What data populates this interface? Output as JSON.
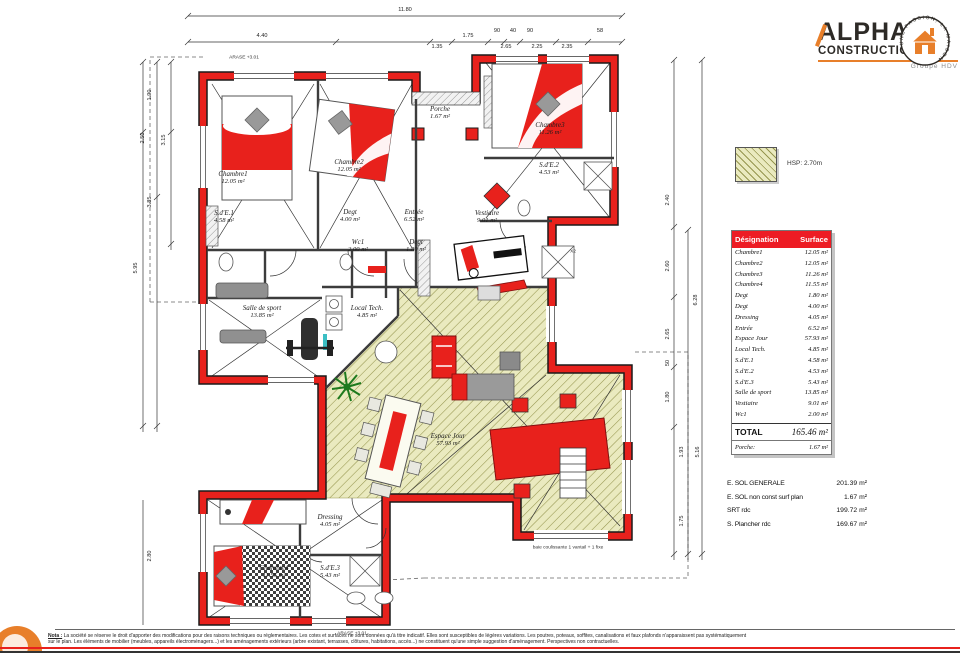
{
  "logo": {
    "name": "ALPHA",
    "name2": "CONSTRUCTIONS",
    "subtitle": "Groupe HDV",
    "stamp_text": "UNE PASSION, LA MAISON",
    "accent_color": "#e87f2a",
    "dark_color": "#2d2a26"
  },
  "legend": {
    "label": "HSP: 2.70m"
  },
  "surface_table": {
    "header": {
      "designation": "Désignation",
      "surface": "Surface"
    },
    "rows": [
      {
        "name": "Chambre1",
        "area": "12.05 m²"
      },
      {
        "name": "Chambre2",
        "area": "12.05 m²"
      },
      {
        "name": "Chambre3",
        "area": "11.26 m²"
      },
      {
        "name": "Chambre4",
        "area": "11.55 m²"
      },
      {
        "name": "Degt",
        "area": "1.80 m²"
      },
      {
        "name": "Degt",
        "area": "4.00 m²"
      },
      {
        "name": "Dressing",
        "area": "4.05 m²"
      },
      {
        "name": "Entrée",
        "area": "6.52 m²"
      },
      {
        "name": "Espace Jour",
        "area": "57.93 m²"
      },
      {
        "name": "Local Tech.",
        "area": "4.85 m²"
      },
      {
        "name": "S.d'E.1",
        "area": "4.58 m²"
      },
      {
        "name": "S.d'E.2",
        "area": "4.53 m²"
      },
      {
        "name": "S.d'E.3",
        "area": "5.43 m²"
      },
      {
        "name": "Salle de sport",
        "area": "13.85 m²"
      },
      {
        "name": "Vestiaire",
        "area": "9.01 m²"
      },
      {
        "name": "Wc1",
        "area": "2.00 m²"
      }
    ],
    "total_label": "TOTAL",
    "total_value": "165.46 m²",
    "porche_label": "Porche:",
    "porche_value": "1.67 m²"
  },
  "totals": {
    "rows": [
      {
        "label": "E. SOL GENERALE",
        "value": "201.39 m²"
      },
      {
        "label": "E. SOL non const surf plan",
        "value": "1.67 m²"
      },
      {
        "label": "SRT rdc",
        "value": "199.72 m²"
      },
      {
        "label": "S. Plancher rdc",
        "value": "169.67 m²"
      }
    ]
  },
  "plan": {
    "colors": {
      "wall": "#e8211c",
      "hatch_fill": "#eaeabf",
      "hatch_line": "#96964f"
    },
    "rooms": [
      {
        "name": "Chambre1",
        "area": "12.05 m²",
        "x": 233,
        "y": 178
      },
      {
        "name": "Chambre2",
        "area": "12.05 m²",
        "x": 349,
        "y": 166
      },
      {
        "name": "Chambre3",
        "area": "11.26 m²",
        "x": 550,
        "y": 129
      },
      {
        "name": "Chambre4",
        "area": "11.55 m²",
        "x": 274,
        "y": 572
      },
      {
        "name": "S.d'E.1",
        "area": "4.58 m²",
        "x": 224,
        "y": 217
      },
      {
        "name": "S.d'E.2",
        "area": "4.53 m²",
        "x": 549,
        "y": 169
      },
      {
        "name": "S.d'E.3",
        "area": "5.43 m²",
        "x": 330,
        "y": 572
      },
      {
        "name": "Degt",
        "area": "4.00 m²",
        "x": 350,
        "y": 216
      },
      {
        "name": "Degt",
        "area": "1.80 m²",
        "x": 416,
        "y": 246
      },
      {
        "name": "Dressing",
        "area": "4.05 m²",
        "x": 330,
        "y": 521
      },
      {
        "name": "Entrée",
        "area": "6.52 m²",
        "x": 414,
        "y": 216
      },
      {
        "name": "Wc1",
        "area": "2.00 m²",
        "x": 358,
        "y": 246
      },
      {
        "name": "Local Tech.",
        "area": "4.85 m²",
        "x": 367,
        "y": 312
      },
      {
        "name": "Salle de sport",
        "area": "13.85 m²",
        "x": 262,
        "y": 312
      },
      {
        "name": "Vestiaire",
        "area": "9.01 m²",
        "x": 487,
        "y": 217
      },
      {
        "name": "Espace Jour",
        "area": "57.93 m²",
        "x": 448,
        "y": 440
      },
      {
        "name": "Porche",
        "area": "1.67 m²",
        "x": 440,
        "y": 113
      }
    ],
    "dims": [
      {
        "t": "11.80",
        "x": 405,
        "y": 10,
        "o": "h"
      },
      {
        "t": "4.40",
        "x": 262,
        "y": 36,
        "o": "h"
      },
      {
        "t": "1.35",
        "x": 437,
        "y": 47,
        "o": "h"
      },
      {
        "t": "1.75",
        "x": 468,
        "y": 36,
        "o": "h"
      },
      {
        "t": "90",
        "x": 497,
        "y": 31,
        "o": "h"
      },
      {
        "t": "40",
        "x": 513,
        "y": 31,
        "o": "h"
      },
      {
        "t": "90",
        "x": 530,
        "y": 31,
        "o": "h"
      },
      {
        "t": "2.65",
        "x": 506,
        "y": 47,
        "o": "h"
      },
      {
        "t": "2.25",
        "x": 537,
        "y": 47,
        "o": "h"
      },
      {
        "t": "2.35",
        "x": 567,
        "y": 47,
        "o": "h"
      },
      {
        "t": "58",
        "x": 600,
        "y": 31,
        "o": "h"
      },
      {
        "t": "1.90",
        "x": 150,
        "y": 95,
        "o": "v"
      },
      {
        "t": "2.50",
        "x": 143,
        "y": 138,
        "o": "v"
      },
      {
        "t": "3.15",
        "x": 164,
        "y": 140,
        "o": "v"
      },
      {
        "t": "3.85",
        "x": 150,
        "y": 202,
        "o": "v"
      },
      {
        "t": "5.95",
        "x": 136,
        "y": 268,
        "o": "v"
      },
      {
        "t": "2.80",
        "x": 150,
        "y": 556,
        "o": "v"
      },
      {
        "t": "2.40",
        "x": 668,
        "y": 200,
        "o": "v"
      },
      {
        "t": "2.60",
        "x": 668,
        "y": 266,
        "o": "v"
      },
      {
        "t": "2.65",
        "x": 668,
        "y": 334,
        "o": "v"
      },
      {
        "t": "50",
        "x": 668,
        "y": 363,
        "o": "v"
      },
      {
        "t": "1.80",
        "x": 668,
        "y": 397,
        "o": "v"
      },
      {
        "t": "6.28",
        "x": 696,
        "y": 300,
        "o": "v"
      },
      {
        "t": "1.93",
        "x": 682,
        "y": 452,
        "o": "v"
      },
      {
        "t": "5.16",
        "x": 698,
        "y": 452,
        "o": "v"
      },
      {
        "t": "1.75",
        "x": 682,
        "y": 521,
        "o": "v"
      }
    ],
    "annotations": [
      {
        "t": "ARASE +3.01",
        "x": 244,
        "y": 58
      },
      {
        "t": "ARASE +3.01",
        "x": 352,
        "y": 634
      },
      {
        "t": "X2",
        "x": 573,
        "y": 252
      },
      {
        "t": "baie coulissante 1 vantail + 1 fixe",
        "x": 568,
        "y": 548
      }
    ]
  },
  "footer": {
    "nota_label": "Nota :",
    "line1": "La société se réserve le droit d'apporter des modifications pour des raisons techniques ou réglementaires. Les cotes et surfaces ne sont données qu'à titre indicatif. Elles sont susceptibles de légères variations. Les poutres, poteaux, soffites, canalisations et faux plafonds n'apparaissent pas systématiquement",
    "line2": "sur le plan. Les éléments de mobilier (meubles, appareils électroménagers...) et les aménagements extérieurs (arbre existant, terrasses, clôtures, habitations, accès...) ne constituent qu'une simple suggestion d'aménagement. Perspectives non contractuelles."
  }
}
